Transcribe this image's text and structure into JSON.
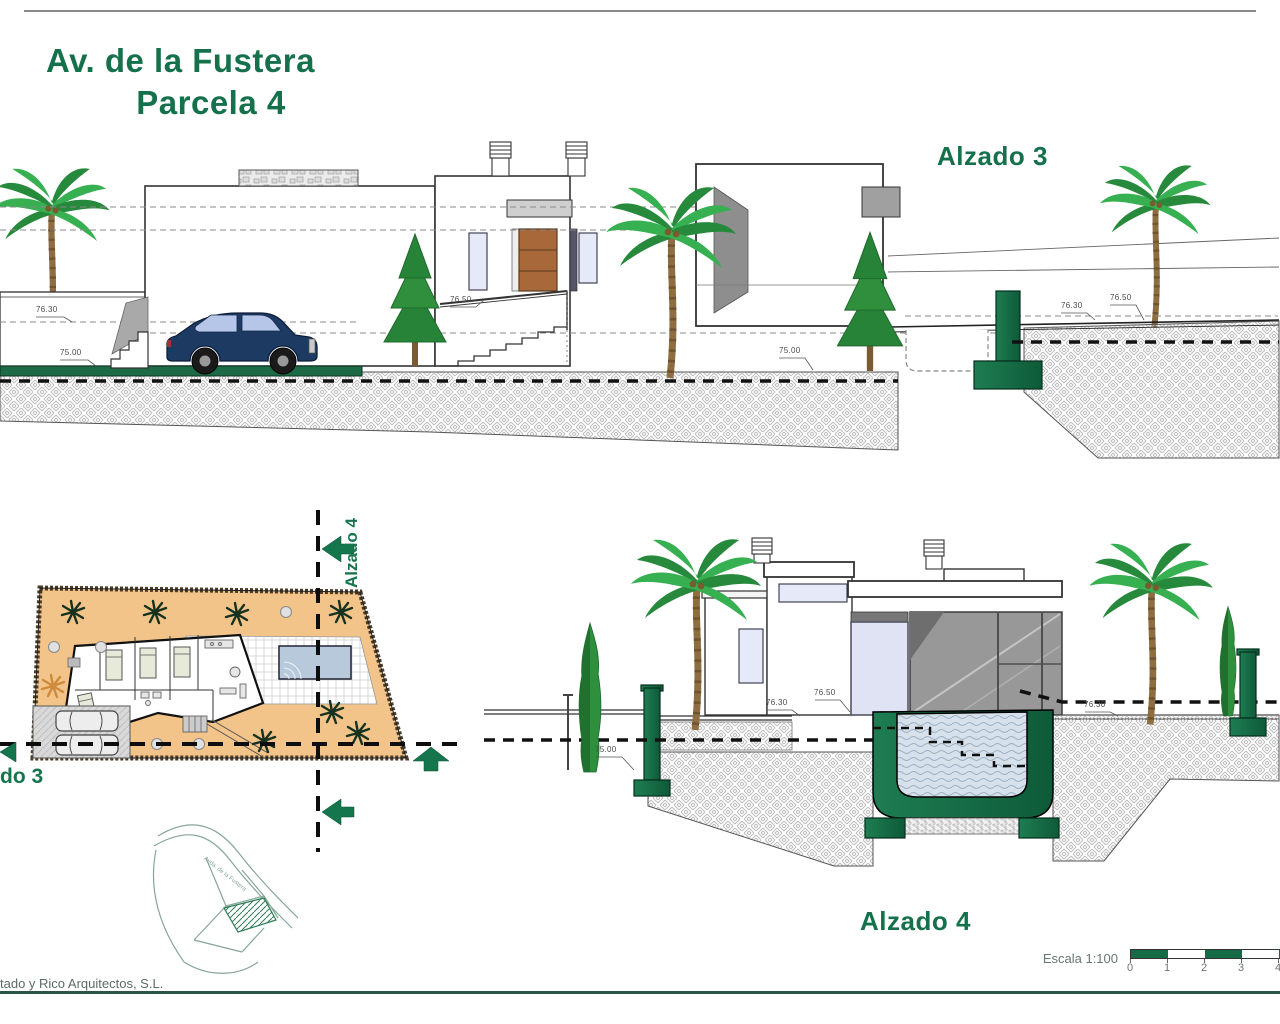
{
  "title": {
    "line1": "Av. de la Fustera",
    "line2": "Parcela 4"
  },
  "labels": {
    "alzado3_title": "Alzado 3",
    "alzado4_title": "Alzado 4",
    "alzado4_section": "Alzado 4",
    "alzado3_section_cut": "do 3",
    "architects": "tado y Rico Arquitectos, S.L.",
    "scale": "Escala 1:100",
    "minimap_road": "Avda. de la Fustera"
  },
  "scale_bar": {
    "ticks": [
      "0",
      "1",
      "2",
      "3",
      "4"
    ]
  },
  "dims_alzado3": [
    "76.30",
    "75.00",
    "76.50",
    "75.00",
    "76.30",
    "76.50"
  ],
  "dims_alzado4": [
    "75.00",
    "76.30",
    "76.50",
    "76.30"
  ],
  "colors": {
    "accent_green": "#15714b",
    "structure_green": "#156b46",
    "terrain_orange": "#f2c489",
    "pool_water": "#c9d7e4"
  }
}
